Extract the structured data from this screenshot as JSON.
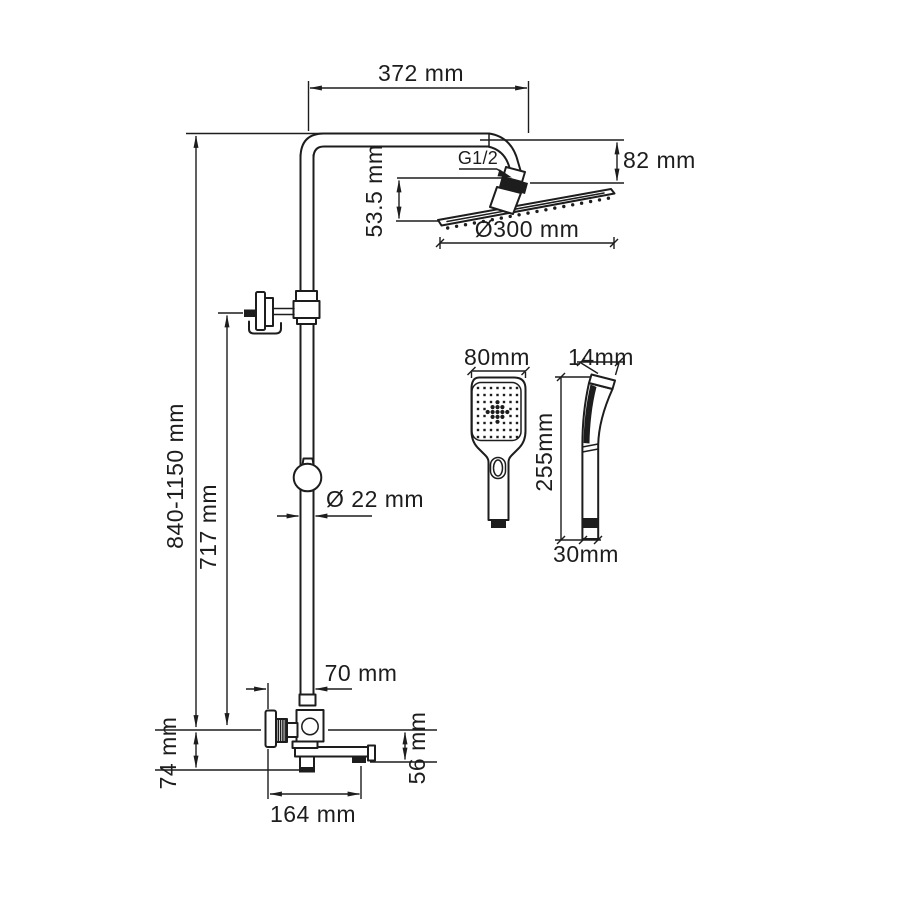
{
  "diagram": {
    "type": "technical-dimension-drawing",
    "subject": "shower column system with rain head, hand shower and bath spout",
    "colors": {
      "line": "#1d1d1d",
      "background": "#ffffff"
    },
    "labels": {
      "arm_reach": "372 mm",
      "head_drop": "82 mm",
      "thread_size": "G1/2",
      "head_offset": "53.5 mm",
      "head_diameter": "Ø300 mm",
      "column_height": "840-1150 mm",
      "bracket_height": "717 mm",
      "pipe_diameter": "Ø 22 mm",
      "handle_offset": "70 mm",
      "wall_offset": "74 mm",
      "spout_length": "164 mm",
      "spout_drop": "56 mm",
      "hand_shower_width": "80mm",
      "hand_shower_depth": "14mm",
      "hand_shower_length": "255mm",
      "hand_shower_handle": "30mm"
    }
  }
}
